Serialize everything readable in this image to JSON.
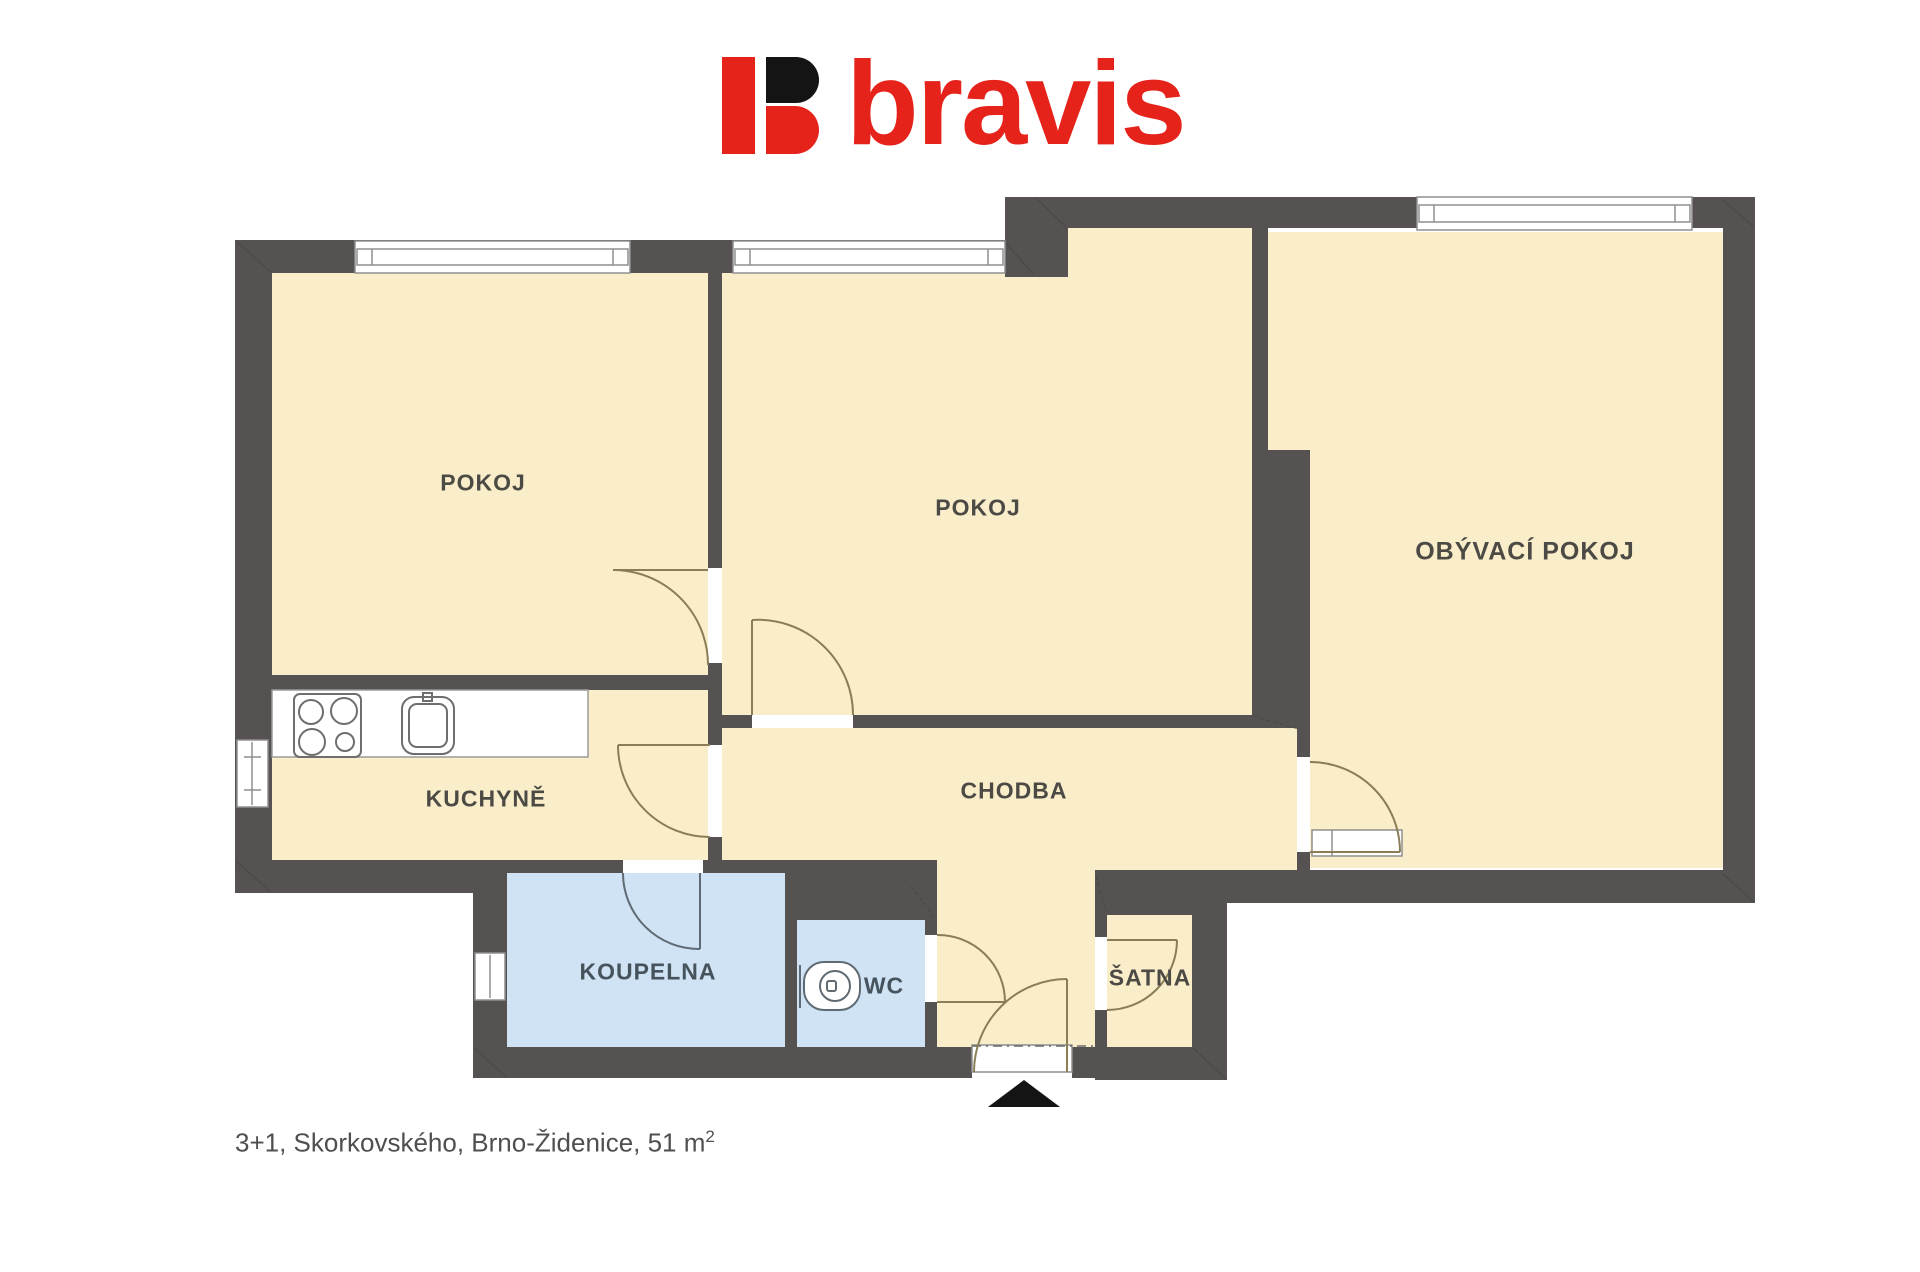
{
  "logo": {
    "brand": "bravis",
    "mark_red": "#e5231b",
    "mark_black": "#141414"
  },
  "rooms": {
    "pokoj1": {
      "label": "POKOJ"
    },
    "pokoj2": {
      "label": "POKOJ"
    },
    "obyvaci": {
      "label": "OBÝVACÍ POKOJ"
    },
    "kuchyne": {
      "label": "KUCHYNĚ"
    },
    "chodba": {
      "label": "CHODBA"
    },
    "koupelna": {
      "label": "KOUPELNA"
    },
    "wc": {
      "label": "WC"
    },
    "satna": {
      "label": "ŠATNA"
    }
  },
  "caption": {
    "text": "3+1, Skorkovského, Brno-Židenice, 51 m",
    "superscript": "2"
  },
  "colors": {
    "wall": "#565251",
    "room_fill": "#faeeca",
    "wet_room_fill": "#cfe3f5",
    "door_line": "#8a7d57",
    "wet_line": "#5f6a72",
    "window_frame": "#8f8f8f",
    "label_text": "#4c4a44",
    "caption_text": "#4f4f4f"
  }
}
